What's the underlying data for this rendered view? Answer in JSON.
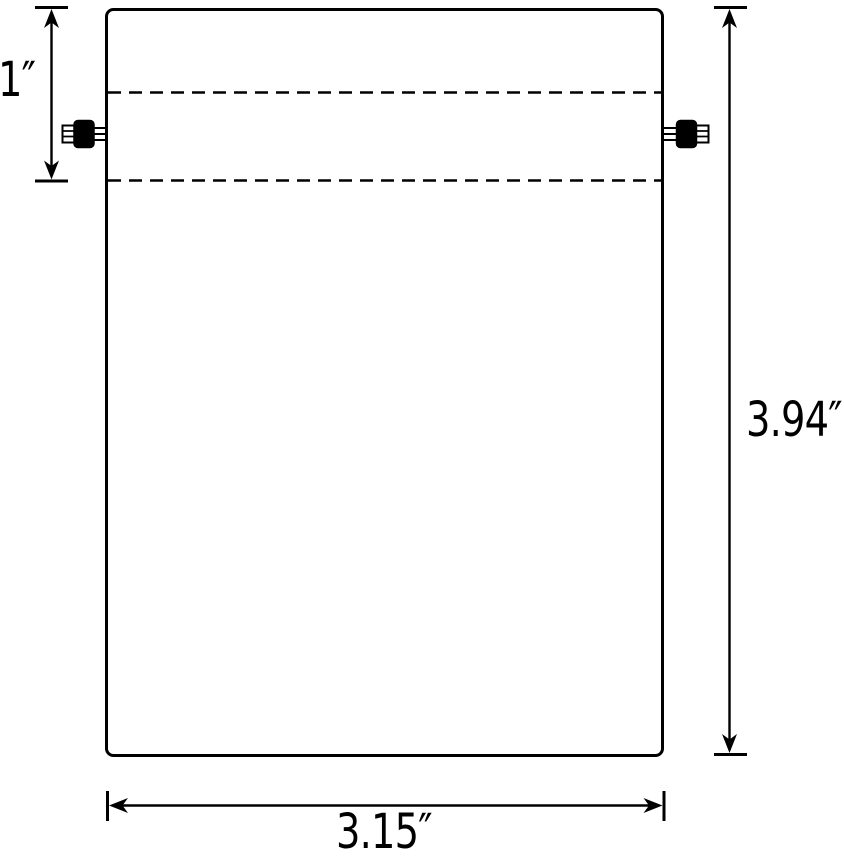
{
  "diagram": {
    "type": "product-dimension-diagram",
    "colors": {
      "line": "#000000",
      "background": "#ffffff"
    },
    "dimensions": {
      "hem_height_label": "1″",
      "bag_height_label": "3.94″",
      "bag_width_label": "3.15″"
    }
  }
}
